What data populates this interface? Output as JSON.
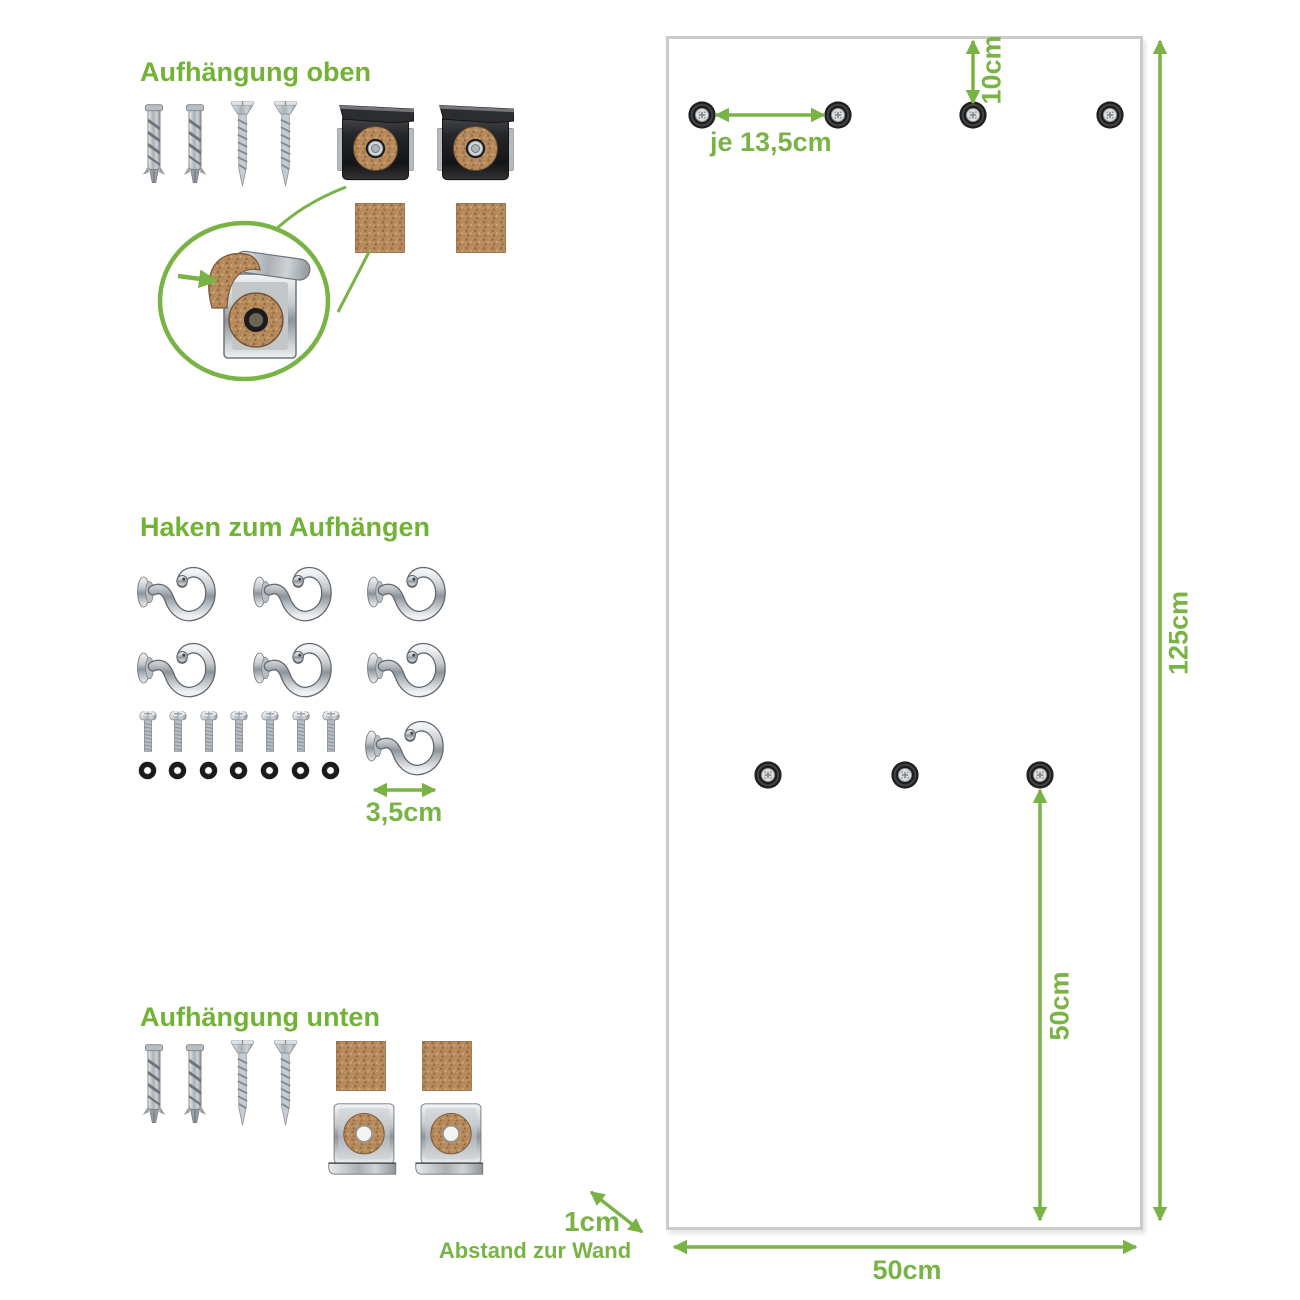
{
  "document_type": "product mounting instructions diagram",
  "language": "de",
  "colors": {
    "background": "#ffffff",
    "title_green": "#72b236",
    "dimension_green": "#79b345",
    "panel_border": "#cbcbcb",
    "cork": "#b5895c",
    "metal_dark": "#232427",
    "metal_chrome": "#c6cacd",
    "washer_black": "#1b1b1b"
  },
  "sections": {
    "top_mount": {
      "title": "Aufhängung oben",
      "parts": [
        {
          "icon": "wall-plug-icon",
          "count": 2
        },
        {
          "icon": "countersunk-screw-icon",
          "count": 2
        },
        {
          "icon": "mirror-clip-top-icon",
          "count": 2
        },
        {
          "icon": "cork-pad-icon",
          "count": 2
        }
      ],
      "detail": "magnifier circle showing clip with cork strip and cork washer"
    },
    "hooks": {
      "title": "Haken zum Aufhängen",
      "parts": [
        {
          "icon": "cup-hook-icon",
          "count": 7
        },
        {
          "icon": "bolt-icon",
          "count": 7
        },
        {
          "icon": "washer-icon",
          "count": 7
        }
      ],
      "hook_width_label": "3,5cm"
    },
    "bottom_mount": {
      "title": "Aufhängung unten",
      "parts": [
        {
          "icon": "wall-plug-icon",
          "count": 2
        },
        {
          "icon": "countersunk-screw-icon",
          "count": 2
        },
        {
          "icon": "cork-pad-icon",
          "count": 2
        },
        {
          "icon": "mirror-clip-bottom-icon",
          "count": 2
        }
      ]
    }
  },
  "panel": {
    "description": "wall panel front view with drill holes",
    "hole_counts": {
      "top_row": 4,
      "middle_row": 3
    },
    "labels": {
      "hole_spacing": "je 13,5cm",
      "top_offset": "10cm",
      "height": "125cm",
      "middle_to_bottom": "50cm",
      "width": "50cm",
      "wall_gap": "1cm",
      "wall_gap_caption": "Abstand zur Wand"
    }
  }
}
